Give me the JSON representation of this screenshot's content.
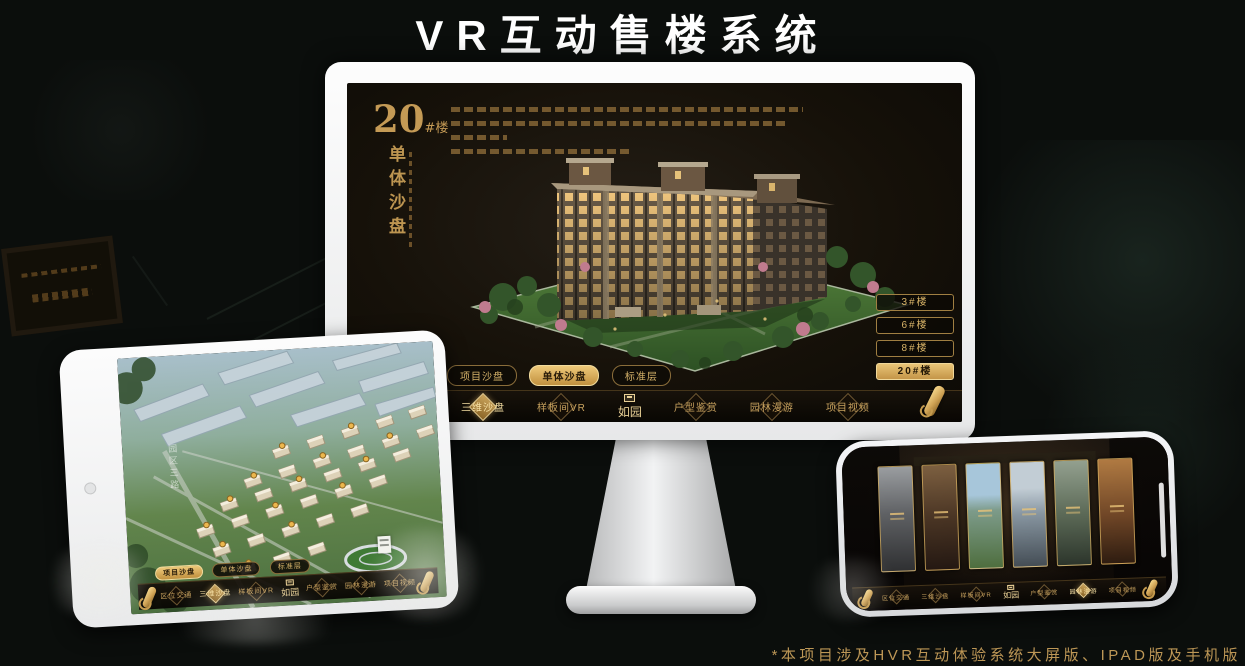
{
  "page": {
    "title": "VR互动售楼系统",
    "footnote": "*本项目涉及HVR互动体验系统大屏版、IPAD版及手机版"
  },
  "brand": {
    "logo_name": "如园",
    "gold": "#d2a85e"
  },
  "nav": {
    "items": [
      {
        "label": "区位交通"
      },
      {
        "label": "三维沙盘"
      },
      {
        "label": "样板间VR"
      },
      {
        "label": "户型鉴赏"
      },
      {
        "label": "园林漫游"
      },
      {
        "label": "项目视频"
      }
    ]
  },
  "tabs": {
    "items": [
      {
        "label": "项目沙盘"
      },
      {
        "label": "单体沙盘"
      },
      {
        "label": "标准层"
      }
    ]
  },
  "monitor": {
    "title_num": "20",
    "title_unit": "#楼",
    "subtitle": "单体沙盘",
    "active_tab": "单体沙盘",
    "active_nav": "三维沙盘",
    "active_floor": "20#楼",
    "floor_buttons": [
      {
        "label": "3#楼"
      },
      {
        "label": "6#楼"
      },
      {
        "label": "8#楼"
      },
      {
        "label": "20#楼"
      }
    ]
  },
  "tablet": {
    "active_tab": "项目沙盘",
    "active_nav": "三维沙盘",
    "road_label": "园区三路"
  },
  "phone": {
    "active_nav": "园林漫游",
    "panel_count": "6"
  }
}
